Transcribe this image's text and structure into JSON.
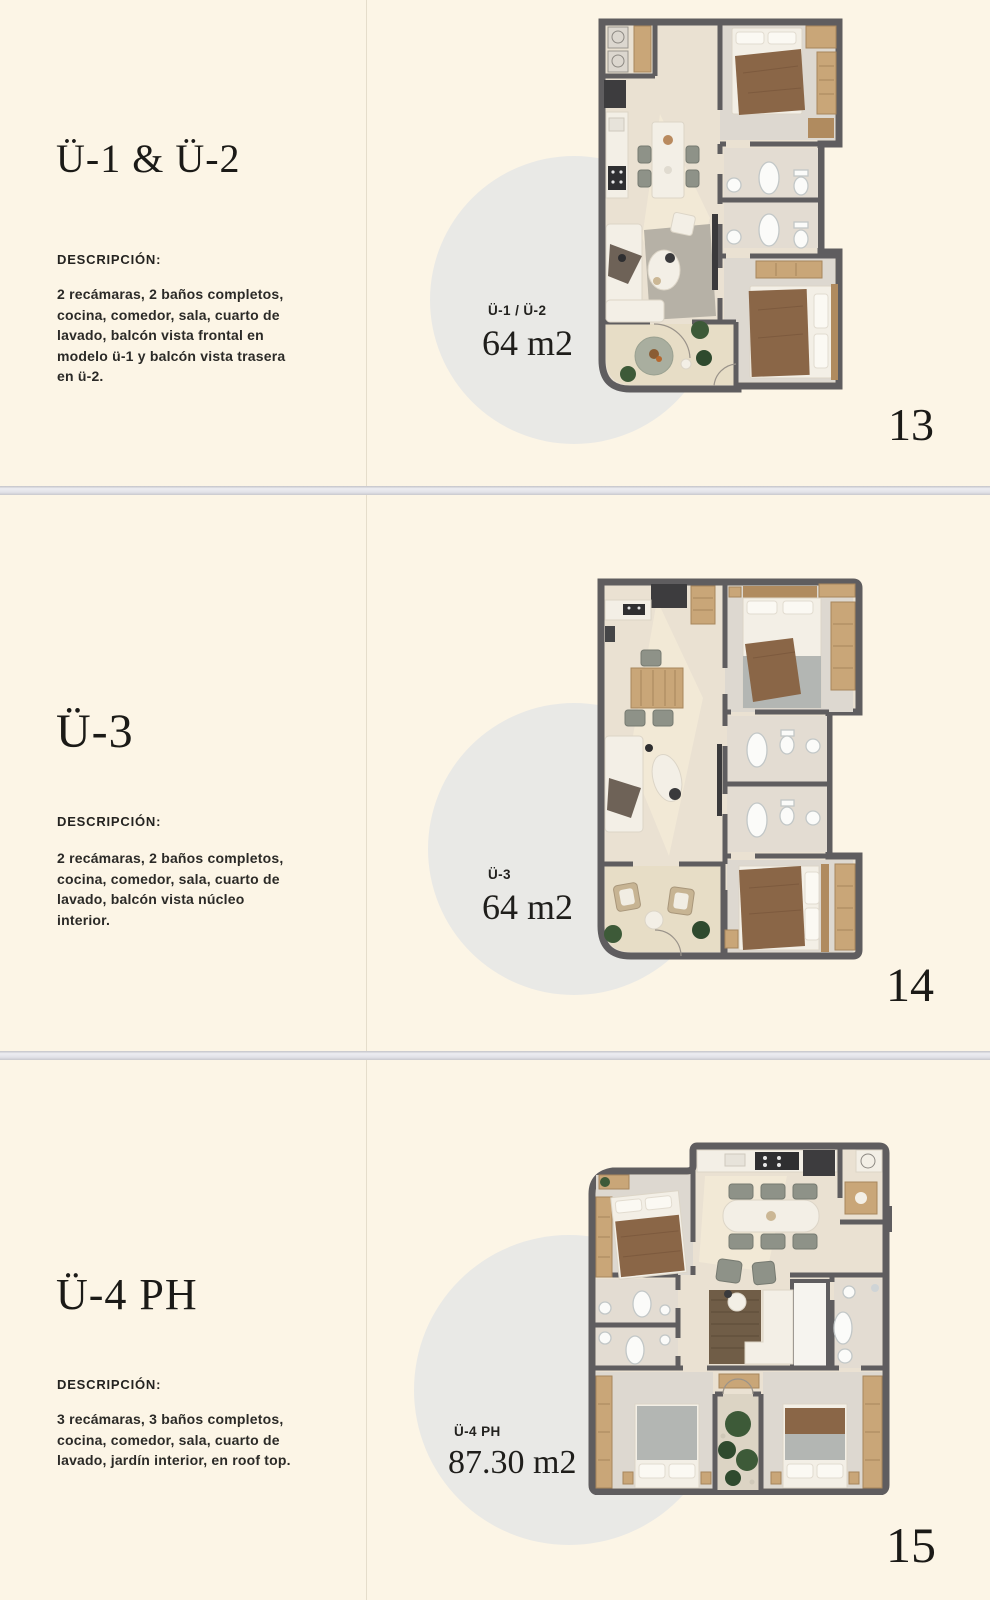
{
  "colors": {
    "background": "#fbf4e5",
    "panel_background": "#fcf5e6",
    "divider": "#d9d9df",
    "accent_circle": "#e9e9e6",
    "title_text": "#1b1a17",
    "body_text": "#2b2a27",
    "plan_wall": "#5f5d5f"
  },
  "sections": [
    {
      "title": "Ü-1 & Ü-2",
      "description_heading": "DESCRIPCIÓN:",
      "description_lines": [
        "2 recámaras, 2 baños completos,",
        "cocina, comedor, sala, cuarto de",
        "lavado, balcón vista frontal en",
        "modelo ü-1 y balcón vista trasera",
        "en ü-2."
      ],
      "unit_label": "Ü-1 / Ü-2",
      "area": "64 m2",
      "page_number": "13",
      "floor_plan_icon": "floor-plan-u1-u2"
    },
    {
      "title": "Ü-3",
      "description_heading": "DESCRIPCIÓN:",
      "description_lines": [
        "2 recámaras, 2 baños completos,",
        "cocina, comedor, sala, cuarto de",
        "lavado, balcón vista núcleo",
        "interior."
      ],
      "unit_label": "Ü-3",
      "area": "64 m2",
      "page_number": "14",
      "floor_plan_icon": "floor-plan-u3"
    },
    {
      "title": "Ü-4 PH",
      "description_heading": "DESCRIPCIÓN:",
      "description_lines": [
        "3 recámaras, 3 baños completos,",
        "cocina, comedor, sala, cuarto de",
        "lavado, jardín interior, en roof top."
      ],
      "unit_label": "Ü-4 PH",
      "area": "87.30 m2",
      "page_number": "15",
      "floor_plan_icon": "floor-plan-u4-ph"
    }
  ]
}
